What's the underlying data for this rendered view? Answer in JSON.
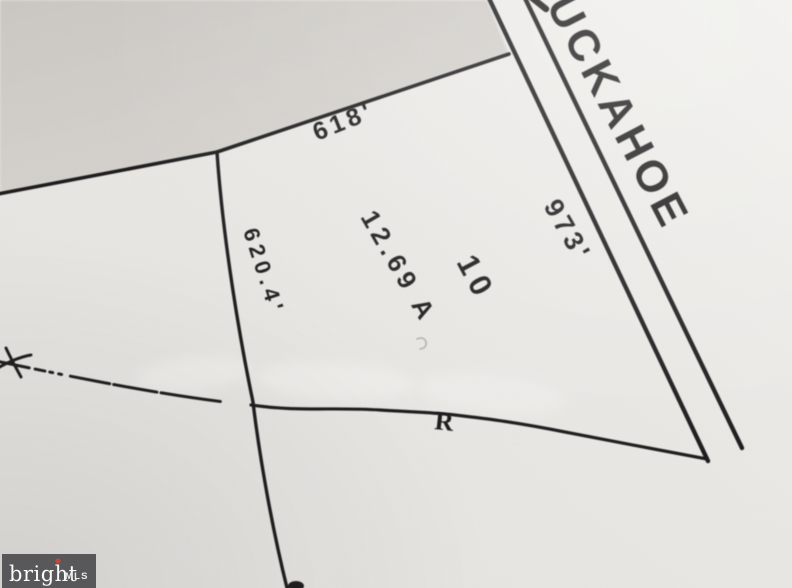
{
  "map": {
    "road_name": "UCKAHOE",
    "parcel": {
      "lot_number": "10",
      "area": "12.69 A"
    },
    "dimensions": {
      "road_frontage": "973'",
      "north_boundary": "618'",
      "west_boundary": "620.4'"
    },
    "boundary_annotation": "R"
  },
  "watermark": {
    "brand": "bright",
    "suffix": "MLS"
  },
  "colors": {
    "paper": "#e8e6e2",
    "paper_light": "#f0efec",
    "shade_region": "#cfccc7",
    "ink": "#1d1d1d",
    "logo_bg": "#58585b",
    "logo_text": "#fbfbf9",
    "logo_star": "#c2473d"
  }
}
